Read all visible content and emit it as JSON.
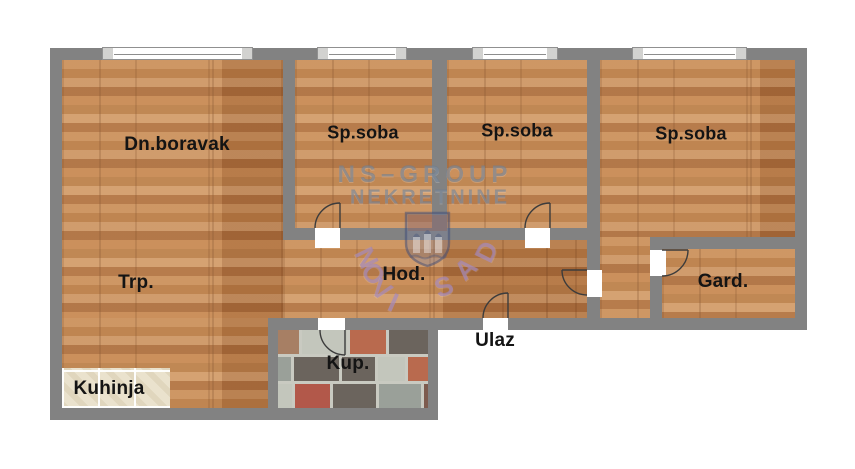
{
  "floorplan": {
    "rooms": [
      {
        "key": "dn_boravak",
        "label": "Dn.boravak"
      },
      {
        "key": "sp_soba_1",
        "label": "Sp.soba"
      },
      {
        "key": "sp_soba_2",
        "label": "Sp.soba"
      },
      {
        "key": "sp_soba_3",
        "label": "Sp.soba"
      },
      {
        "key": "trpezarija",
        "label": "Trp."
      },
      {
        "key": "hodnik",
        "label": "Hod."
      },
      {
        "key": "ulaz",
        "label": "Ulaz"
      },
      {
        "key": "garderoba",
        "label": "Gard."
      },
      {
        "key": "kuhinja",
        "label": "Kuhinja"
      },
      {
        "key": "kupatilo",
        "label": "Kup."
      }
    ],
    "watermark": {
      "agency_line1": "NS–GROUP",
      "agency_line2": "NEKRETNINE",
      "city_arc": "NOVI SAD"
    },
    "colors": {
      "wall": "#828282",
      "outside": "#ffffff",
      "label_ink": "#141414",
      "wood_base": "#c08550",
      "kitchen_tile": "#eae2cd",
      "watermark_agency": "rgba(109,126,146,0.62)",
      "watermark_city": "rgba(160,131,184,0.66)",
      "bath_tile_palette": [
        "#6b645d",
        "#9aa099",
        "#b2584a",
        "#8a8b85",
        "#55504a",
        "#a77f64",
        "#c3c6bc",
        "#7d5b4e",
        "#b96a4e",
        "#8f9a97"
      ]
    }
  }
}
